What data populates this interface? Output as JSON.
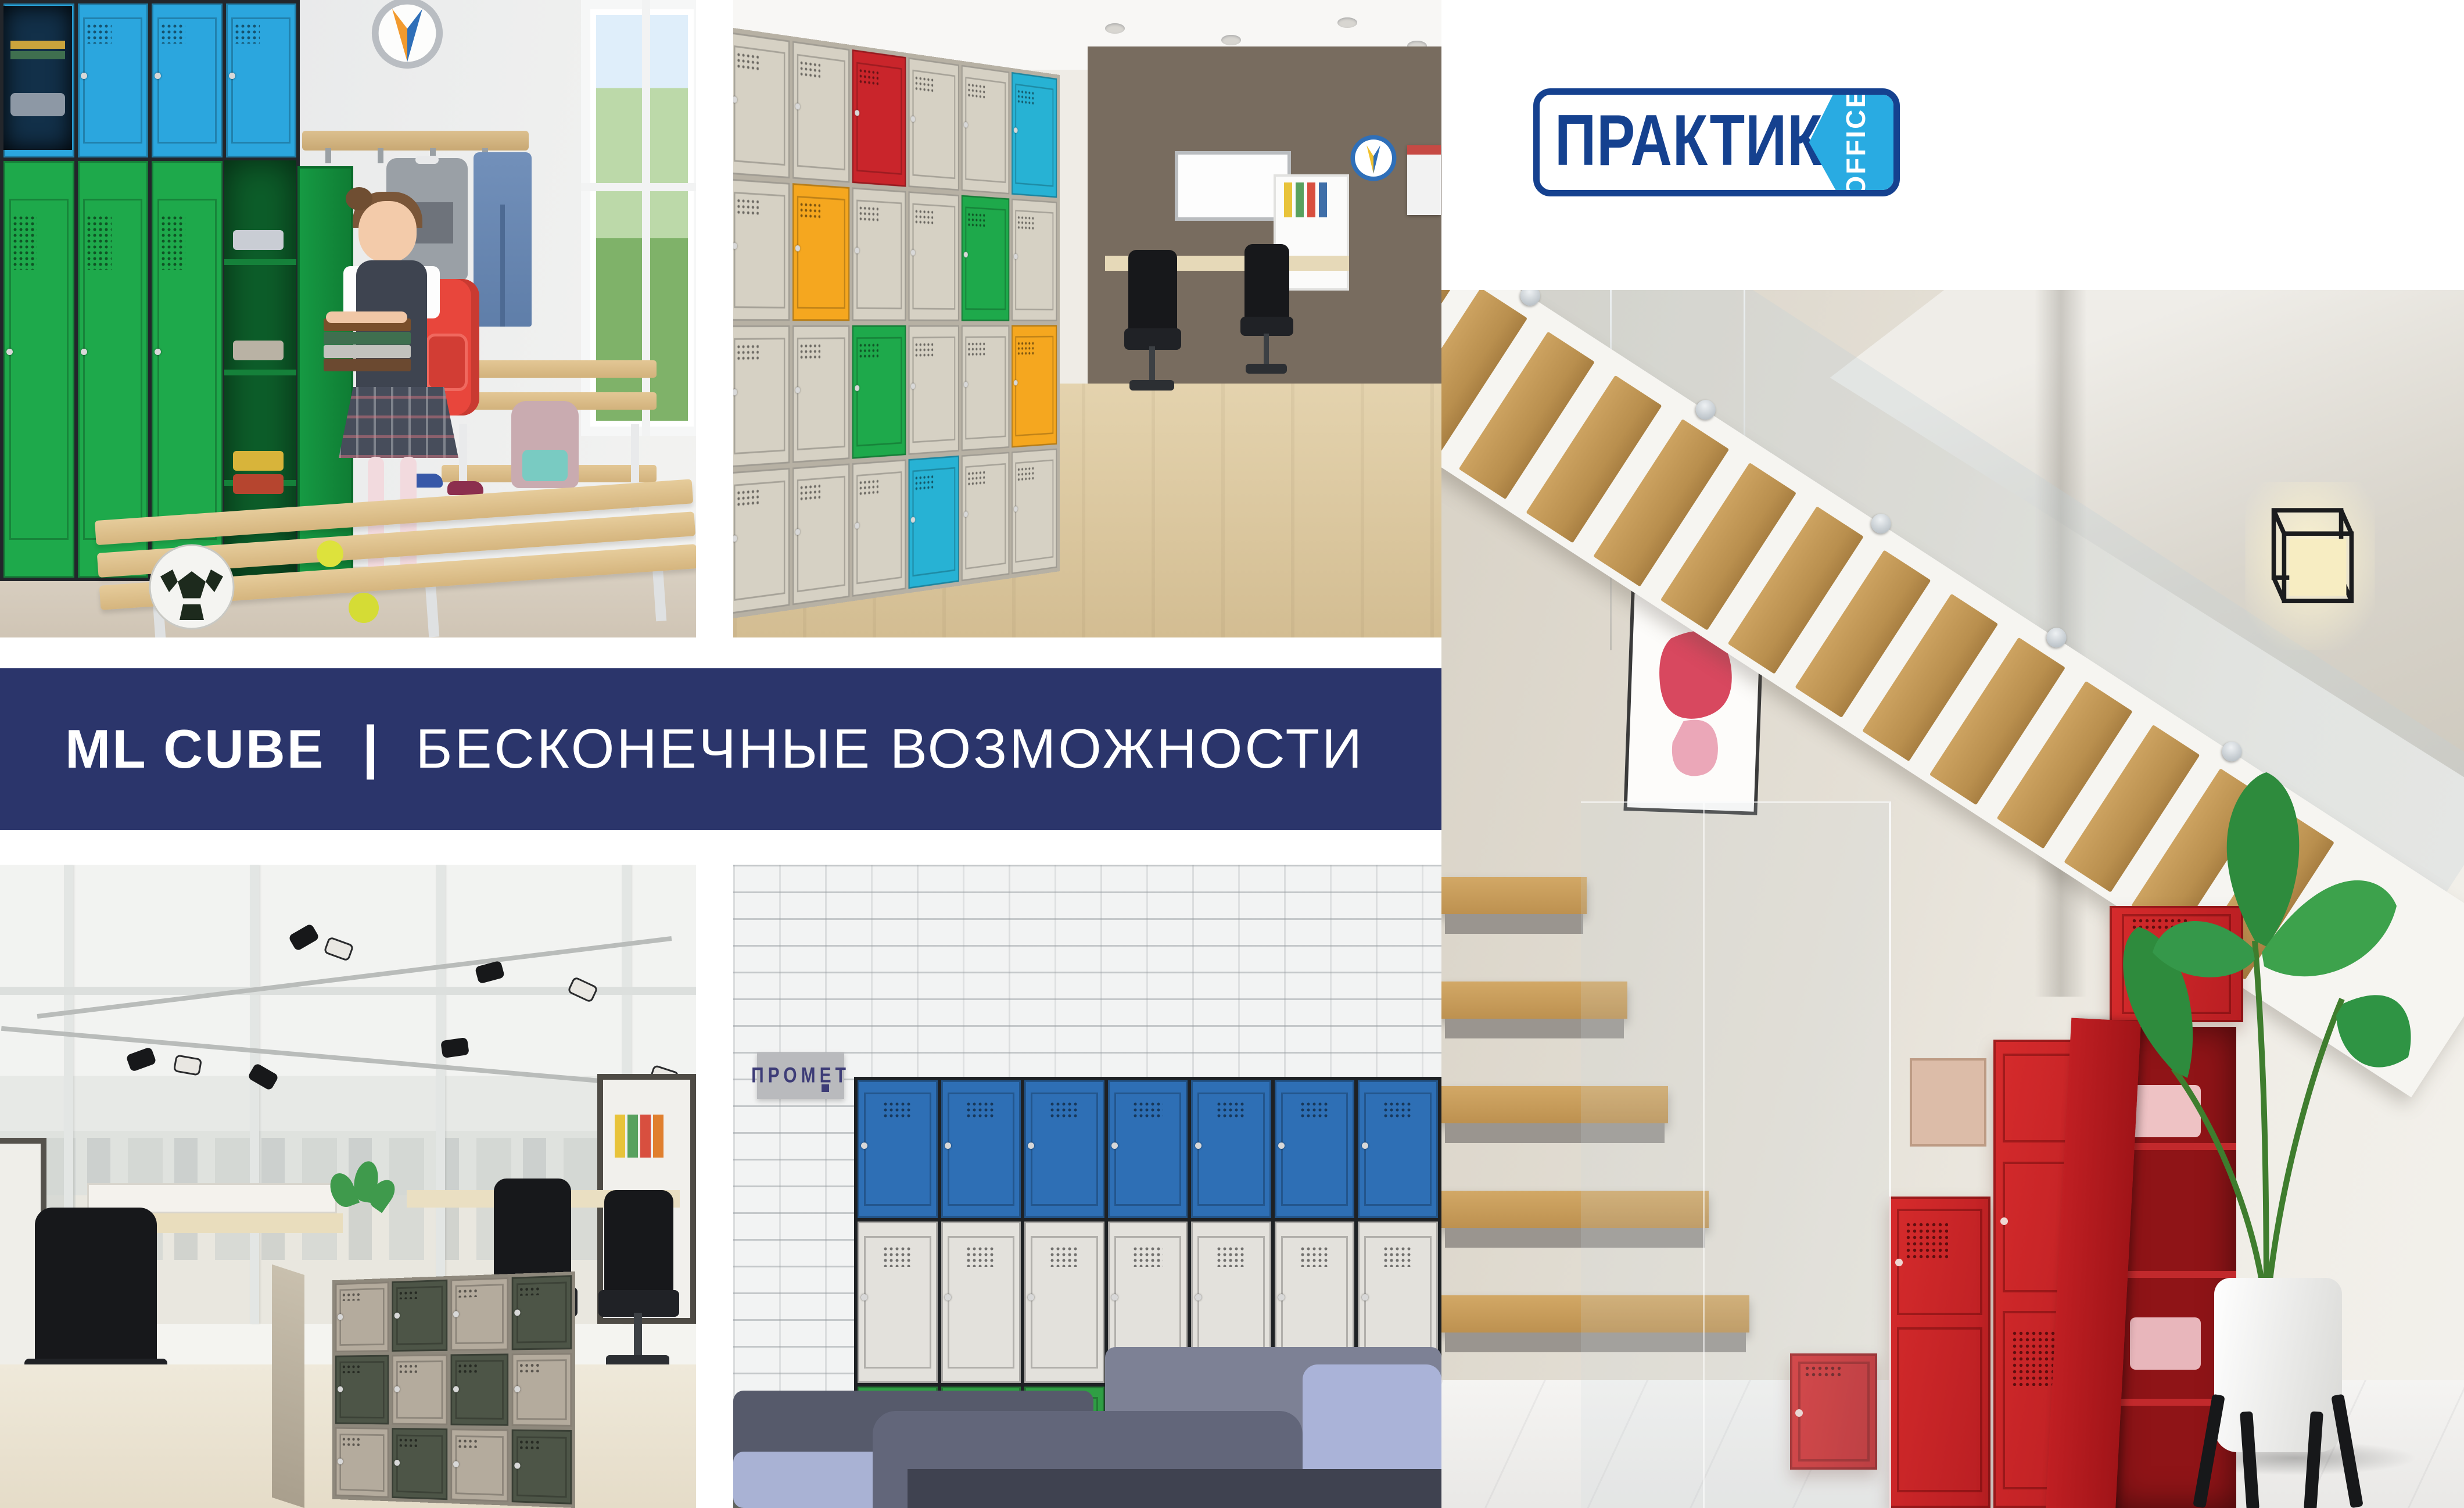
{
  "page": {
    "background": "#ffffff"
  },
  "logo": {
    "brand": "ПРАКТИК",
    "suffix": "OFFICE",
    "brand_color": "#15418f",
    "accent_color": "#29abe2"
  },
  "banner": {
    "product": "ML CUBE",
    "divider": "|",
    "tagline": "БЕСКОНЕЧНЫЕ ВОЗМОЖНОСТИ",
    "background": "#2b356b",
    "text_color": "#ffffff"
  },
  "sign": {
    "text": "ПРОМЕТ",
    "plaque_color": "#b9babd",
    "text_color": "#3d3c77"
  },
  "palette": {
    "green": "#1ea94b",
    "sky_blue": "#2ba6de",
    "royal_blue": "#2e6fb5",
    "mid_green": "#2f9e44",
    "white_door": "#e3e1dc",
    "red": "#c9252b",
    "orange": "#f5a71f",
    "teal": "#27b2d4",
    "cream": "#d6d1c4",
    "taupe": "#b4ab9d",
    "olive": "#4d5547",
    "locker_red": "#d1282b"
  },
  "grids": {
    "school": {
      "row_heights": [
        0.27,
        0.73
      ],
      "cells": [
        [
          "sky_blue",
          "sky_blue",
          "sky_blue",
          "sky_blue"
        ],
        [
          "green",
          "green",
          "green",
          "green"
        ]
      ]
    },
    "office_wall": {
      "cells": [
        [
          "cream",
          "cream",
          "red",
          "cream",
          "cream",
          "teal"
        ],
        [
          "cream",
          "orange",
          "cream",
          "cream",
          "green",
          "cream"
        ],
        [
          "cream",
          "cream",
          "green",
          "cream",
          "cream",
          "orange"
        ],
        [
          "cream",
          "cream",
          "cream",
          "teal",
          "cream",
          "cream"
        ]
      ]
    },
    "checker": {
      "cells": [
        [
          "taupe",
          "olive",
          "taupe",
          "olive"
        ],
        [
          "olive",
          "taupe",
          "olive",
          "taupe"
        ],
        [
          "taupe",
          "olive",
          "taupe",
          "olive"
        ]
      ]
    },
    "brick_bank": {
      "row_heights": [
        0.33,
        0.387,
        0.283
      ],
      "cells": [
        [
          "royal_blue",
          "royal_blue",
          "royal_blue",
          "royal_blue",
          "royal_blue",
          "royal_blue",
          "royal_blue"
        ],
        [
          "white_door",
          "white_door",
          "white_door",
          "white_door",
          "white_door",
          "white_door",
          "white_door"
        ],
        [
          "mid_green",
          "mid_green",
          "mid_green",
          "mid_green",
          "mid_green",
          "mid_green",
          "mid_green"
        ]
      ]
    }
  },
  "photos": [
    {
      "id": "school-locker-room",
      "alt": "Girl with red backpack and books beside green lockers with blue top boxes in a school cloakroom"
    },
    {
      "id": "office-cube-locker-wall",
      "alt": "Wall of multicolour cube lockers in an office"
    },
    {
      "id": "stairs-red-lockers",
      "alt": "Red step lockers under a wooden staircase with a banana plant"
    },
    {
      "id": "open-space-office-cubes",
      "alt": "Open space office with checkerboard cube locker block"
    },
    {
      "id": "brick-wall-lockers-sofa",
      "alt": "Blue, white and green lockers on a white brick wall behind a grey sofa"
    }
  ]
}
